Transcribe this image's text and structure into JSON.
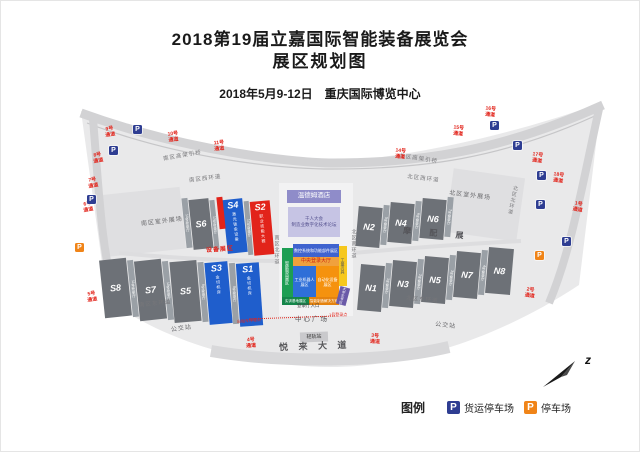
{
  "title": {
    "line1": "2018第19届立嘉国际智能装备展览会",
    "line2": "展区规划图",
    "subtitle": "2018年5月9-12日　重庆国际博览中心"
  },
  "legend": {
    "label": "图例",
    "items": [
      {
        "icon": "P",
        "color": "#2e3d92",
        "label": "货运停车场"
      },
      {
        "icon": "P",
        "color": "#f08418",
        "label": "停车场"
      }
    ]
  },
  "compass": {
    "letter": "z"
  },
  "map": {
    "halls": [
      {
        "id": "S6",
        "label": "S6",
        "type": "gray",
        "x": 190,
        "y": 198,
        "w": 20,
        "h": 50,
        "rot": -6,
        "sub": ""
      },
      {
        "id": "S4",
        "label": "S4",
        "type": "blue",
        "x": 224,
        "y": 198,
        "w": 20,
        "h": 54,
        "rot": -6,
        "sub": "激光钣金设备"
      },
      {
        "id": "S2",
        "label": "S2",
        "type": "red",
        "x": 251,
        "y": 200,
        "w": 20,
        "h": 54,
        "rot": -5,
        "sub": "职业技能大赛"
      },
      {
        "id": "S8",
        "label": "S8",
        "type": "gray",
        "x": 101,
        "y": 258,
        "w": 27,
        "h": 58,
        "rot": -6,
        "sub": ""
      },
      {
        "id": "S7",
        "label": "S7",
        "type": "gray",
        "x": 136,
        "y": 259,
        "w": 27,
        "h": 60,
        "rot": -6,
        "sub": ""
      },
      {
        "id": "S5",
        "label": "S5",
        "type": "gray",
        "x": 171,
        "y": 260,
        "w": 27,
        "h": 61,
        "rot": -5,
        "sub": ""
      },
      {
        "id": "S3",
        "label": "S3",
        "type": "blue",
        "x": 206,
        "y": 261,
        "w": 23,
        "h": 62,
        "rot": -5,
        "sub": "金切机床"
      },
      {
        "id": "S1",
        "label": "S1",
        "type": "blue",
        "x": 237,
        "y": 262,
        "w": 23,
        "h": 63,
        "rot": -4,
        "sub": "金切机床"
      },
      {
        "id": "N2",
        "label": "N2",
        "type": "gray",
        "x": 356,
        "y": 206,
        "w": 24,
        "h": 40,
        "rot": 5,
        "sub": ""
      },
      {
        "id": "N4",
        "label": "N4",
        "type": "gray",
        "x": 388,
        "y": 202,
        "w": 24,
        "h": 40,
        "rot": 5,
        "sub": ""
      },
      {
        "id": "N6",
        "label": "N6",
        "type": "gray",
        "x": 420,
        "y": 198,
        "w": 24,
        "h": 40,
        "rot": 5,
        "sub": ""
      },
      {
        "id": "N1",
        "label": "N1",
        "type": "gray",
        "x": 358,
        "y": 264,
        "w": 24,
        "h": 46,
        "rot": 5,
        "sub": ""
      },
      {
        "id": "N3",
        "label": "N3",
        "type": "gray",
        "x": 390,
        "y": 260,
        "w": 24,
        "h": 46,
        "rot": 5,
        "sub": ""
      },
      {
        "id": "N5",
        "label": "N5",
        "type": "gray",
        "x": 422,
        "y": 256,
        "w": 24,
        "h": 46,
        "rot": 5,
        "sub": ""
      },
      {
        "id": "N7",
        "label": "N7",
        "type": "gray",
        "x": 454,
        "y": 251,
        "w": 24,
        "h": 46,
        "rot": 5,
        "sub": ""
      },
      {
        "id": "N8",
        "label": "N8",
        "type": "gray",
        "x": 486,
        "y": 247,
        "w": 25,
        "h": 46,
        "rot": 5,
        "sub": ""
      }
    ],
    "strips": [
      {
        "label": "14号登录厅",
        "x": 183,
        "y": 197,
        "w": 6,
        "h": 50,
        "rot": -6
      },
      {
        "label": "13号登录厅",
        "x": 211,
        "y": 199,
        "w": 5,
        "h": 50,
        "rot": -6
      },
      {
        "label": "12号登录厅",
        "x": 245,
        "y": 200,
        "w": 5,
        "h": 54,
        "rot": -5
      },
      {
        "label": "11号登录厅",
        "x": 129,
        "y": 259,
        "w": 6,
        "h": 57,
        "rot": -6
      },
      {
        "label": "10号登录厅",
        "x": 164,
        "y": 260,
        "w": 6,
        "h": 59,
        "rot": -6
      },
      {
        "label": "9号登录厅",
        "x": 199,
        "y": 261,
        "w": 6,
        "h": 60,
        "rot": -5
      },
      {
        "label": "8号登录厅",
        "x": 230,
        "y": 262,
        "w": 6,
        "h": 61,
        "rot": -4
      },
      {
        "label": "5号登录厅",
        "x": 381,
        "y": 204,
        "w": 6,
        "h": 40,
        "rot": 5
      },
      {
        "label": "6号登录厅",
        "x": 413,
        "y": 200,
        "w": 6,
        "h": 40,
        "rot": 5
      },
      {
        "label": "7号登录厅",
        "x": 445,
        "y": 196,
        "w": 6,
        "h": 40,
        "rot": 5
      },
      {
        "label": "1号登录厅",
        "x": 383,
        "y": 262,
        "w": 6,
        "h": 45,
        "rot": 5
      },
      {
        "label": "2号登录厅",
        "x": 415,
        "y": 258,
        "w": 6,
        "h": 45,
        "rot": 5
      },
      {
        "label": "3号登录厅",
        "x": 447,
        "y": 254,
        "w": 6,
        "h": 45,
        "rot": 5
      },
      {
        "label": "4号登录厅",
        "x": 479,
        "y": 249,
        "w": 6,
        "h": 45,
        "rot": 5
      }
    ],
    "buildings": [
      {
        "name": "wyndham-hotel",
        "text": "温德姆酒店",
        "x": 286,
        "y": 189,
        "w": 54,
        "h": 13,
        "bg": "#8f8cc9",
        "fg": "#ffffff",
        "size": 6.5,
        "rot": 0,
        "vert": false
      },
      {
        "name": "forum-hall",
        "text": "千人大会\n制造业数字化技术论坛",
        "x": 287,
        "y": 206,
        "w": 52,
        "h": 30,
        "bg": "#c6c4e4",
        "fg": "#55518f",
        "size": 4.5,
        "rot": 0,
        "vert": false
      },
      {
        "name": "light-rail-station",
        "text": "轻轨站",
        "x": 299,
        "y": 331,
        "w": 28,
        "h": 10,
        "bg": "#c9c9cc",
        "fg": "#333333",
        "size": 5,
        "rot": -2,
        "vert": false
      }
    ],
    "zones": [
      {
        "name": "zone-cnc-systems",
        "text": "数控系统和功能部件展区",
        "x": 292,
        "y": 243,
        "w": 46,
        "h": 13,
        "bg": "#3f63cf",
        "fg": "#ffffff",
        "size": 4,
        "rot": 0,
        "vert": false
      },
      {
        "name": "zone-central-hall",
        "text": "中央登录大厅",
        "x": 292,
        "y": 256,
        "w": 46,
        "h": 9,
        "bg": "#f0a13d",
        "fg": "#cc2211",
        "size": 5,
        "rot": 0,
        "vert": false
      },
      {
        "name": "zone-smart-mfg",
        "text": "智能制造展区",
        "x": 281,
        "y": 247,
        "w": 11,
        "h": 49,
        "bg": "#1d9e53",
        "fg": "#ffffff",
        "size": 4,
        "rot": 0,
        "vert": true
      },
      {
        "name": "zone-robot",
        "text": "工业机器人展区",
        "x": 292,
        "y": 265,
        "w": 23,
        "h": 31,
        "bg": "#2f6fd8",
        "fg": "#ffffff",
        "size": 4,
        "rot": 0,
        "vert": false
      },
      {
        "name": "zone-automation",
        "text": "自动化设备展区",
        "x": 315,
        "y": 265,
        "w": 23,
        "h": 31,
        "bg": "#f5920e",
        "fg": "#ffffff",
        "size": 4,
        "rot": 0,
        "vert": false
      },
      {
        "name": "zone-tools",
        "text": "工量刃具",
        "x": 338,
        "y": 245,
        "w": 8,
        "h": 40,
        "bg": "#f6c81d",
        "fg": "#555555",
        "size": 4,
        "rot": 0,
        "vert": true
      },
      {
        "name": "zone-training-base",
        "text": "实训基地展区",
        "x": 281,
        "y": 296,
        "w": 27,
        "h": 8,
        "bg": "#15864a",
        "fg": "#ffffff",
        "size": 3.5,
        "rot": 0,
        "vert": false
      },
      {
        "name": "zone-solutions",
        "text": "智能制造解决方案",
        "x": 308,
        "y": 296,
        "w": 30,
        "h": 8,
        "bg": "#e5830f",
        "fg": "#ffffff",
        "size": 3.5,
        "rot": 0,
        "vert": false
      },
      {
        "name": "zone-students",
        "text": "大学生专区",
        "x": 337,
        "y": 286,
        "w": 10,
        "h": 18,
        "bg": "#6a5aa8",
        "fg": "#ffffff",
        "size": 3.5,
        "rot": 15,
        "vert": true
      },
      {
        "name": "zone-s4-red-strip",
        "text": "",
        "x": 217,
        "y": 196,
        "w": 6,
        "h": 32,
        "bg": "#e2231a",
        "fg": "#ffffff",
        "size": 3,
        "rot": -6,
        "vert": true
      }
    ],
    "labels": [
      {
        "text": "南区高架引桥",
        "x": 162,
        "y": 152,
        "size": 5.5,
        "rot": -10,
        "color": "#77777a",
        "sp": 1,
        "bold": false,
        "vert": false
      },
      {
        "text": "南区西环道",
        "x": 188,
        "y": 175,
        "size": 5.5,
        "rot": -7,
        "color": "#77777a",
        "sp": 1,
        "bold": false,
        "vert": false
      },
      {
        "text": "南区室外展场",
        "x": 140,
        "y": 218,
        "size": 6,
        "rot": -7,
        "color": "#6a6a6d",
        "sp": 1,
        "bold": false,
        "vert": false
      },
      {
        "text": "南区东环道",
        "x": 138,
        "y": 300,
        "size": 5.5,
        "rot": -6,
        "color": "#77777a",
        "sp": 1,
        "bold": false,
        "vert": false
      },
      {
        "text": "公交站",
        "x": 170,
        "y": 325,
        "size": 6,
        "rot": -8,
        "color": "#6a6a6d",
        "sp": 1,
        "bold": false,
        "vert": false
      },
      {
        "text": "悦 来 大 道",
        "x": 278,
        "y": 341,
        "size": 9,
        "rot": -2,
        "color": "#555558",
        "sp": 4,
        "bold": true,
        "vert": false
      },
      {
        "text": "中心广场",
        "x": 294,
        "y": 315,
        "size": 6.5,
        "rot": 0,
        "color": "#555558",
        "sp": 2,
        "bold": false,
        "vert": false
      },
      {
        "text": "登录厅入口",
        "x": 296,
        "y": 303,
        "size": 4.5,
        "rot": 0,
        "color": "#444446",
        "sp": 0,
        "bold": false,
        "vert": false
      },
      {
        "text": "北区高架引桥",
        "x": 398,
        "y": 155,
        "size": 5.5,
        "rot": 9,
        "color": "#77777a",
        "sp": 1,
        "bold": false,
        "vert": false
      },
      {
        "text": "北区西环道",
        "x": 406,
        "y": 175,
        "size": 5.5,
        "rot": 7,
        "color": "#77777a",
        "sp": 1,
        "bold": false,
        "vert": false
      },
      {
        "text": "北区室外展场",
        "x": 448,
        "y": 192,
        "size": 6,
        "rot": 7,
        "color": "#6a6a6d",
        "sp": 1,
        "bold": false,
        "vert": false
      },
      {
        "text": "摩 配 展",
        "x": 402,
        "y": 229,
        "size": 8,
        "rot": 5,
        "color": "#55555a",
        "sp": 8,
        "bold": true,
        "vert": false
      },
      {
        "text": "北区东环道",
        "x": 405,
        "y": 296,
        "size": 5.5,
        "rot": 5,
        "color": "#77777a",
        "sp": 1,
        "bold": false,
        "vert": false
      },
      {
        "text": "公交站",
        "x": 434,
        "y": 322,
        "size": 6,
        "rot": 6,
        "color": "#6a6a6d",
        "sp": 1,
        "bold": false,
        "vert": false
      },
      {
        "text": "设备展区",
        "x": 205,
        "y": 246,
        "size": 6,
        "rot": -4,
        "color": "#e2231a",
        "sp": 1,
        "bold": true,
        "vert": false
      },
      {
        "text": "出租车停靠点",
        "x": 236,
        "y": 318,
        "size": 4,
        "rot": -5,
        "color": "#e2231a",
        "sp": 0,
        "bold": false,
        "vert": false
      },
      {
        "text": "1号登录点",
        "x": 328,
        "y": 312,
        "size": 4,
        "rot": 0,
        "color": "#e2231a",
        "sp": 0,
        "bold": false,
        "vert": false
      },
      {
        "text": "南区北环道",
        "x": 272,
        "y": 234,
        "size": 5,
        "rot": 0,
        "color": "#77777a",
        "sp": 1,
        "bold": false,
        "vert": true
      },
      {
        "text": "北区南环道",
        "x": 349,
        "y": 228,
        "size": 5,
        "rot": 0,
        "color": "#77777a",
        "sp": 1,
        "bold": false,
        "vert": true
      },
      {
        "text": "北区北环道",
        "x": 508,
        "y": 184,
        "size": 5,
        "rot": 12,
        "color": "#77777a",
        "sp": 1,
        "bold": false,
        "vert": true
      }
    ],
    "passages": [
      {
        "text": "9号通道",
        "x": 104,
        "y": 126,
        "rot": -8
      },
      {
        "text": "10号通道",
        "x": 167,
        "y": 131,
        "rot": -6
      },
      {
        "text": "11号通道",
        "x": 213,
        "y": 140,
        "rot": -4
      },
      {
        "text": "8号通道",
        "x": 92,
        "y": 152,
        "rot": -10
      },
      {
        "text": "7号通道",
        "x": 87,
        "y": 177,
        "rot": -10
      },
      {
        "text": "6号通道",
        "x": 82,
        "y": 201,
        "rot": -10
      },
      {
        "text": "5号通道",
        "x": 86,
        "y": 291,
        "rot": -8
      },
      {
        "text": "4号通道",
        "x": 245,
        "y": 337,
        "rot": -3
      },
      {
        "text": "3号通道",
        "x": 369,
        "y": 333,
        "rot": 3
      },
      {
        "text": "2号通道",
        "x": 524,
        "y": 287,
        "rot": 8
      },
      {
        "text": "1号通道",
        "x": 572,
        "y": 201,
        "rot": 10
      },
      {
        "text": "14号通道",
        "x": 394,
        "y": 148,
        "rot": 6
      },
      {
        "text": "15号通道",
        "x": 452,
        "y": 125,
        "rot": 6
      },
      {
        "text": "16号通道",
        "x": 484,
        "y": 106,
        "rot": 6
      },
      {
        "text": "17号通道",
        "x": 531,
        "y": 152,
        "rot": 8
      },
      {
        "text": "18号通道",
        "x": 552,
        "y": 172,
        "rot": 8
      }
    ],
    "parking": [
      {
        "x": 132,
        "y": 124,
        "kind": "blue"
      },
      {
        "x": 108,
        "y": 145,
        "kind": "blue"
      },
      {
        "x": 86,
        "y": 194,
        "kind": "blue"
      },
      {
        "x": 74,
        "y": 242,
        "kind": "orange"
      },
      {
        "x": 489,
        "y": 120,
        "kind": "blue"
      },
      {
        "x": 512,
        "y": 140,
        "kind": "blue"
      },
      {
        "x": 536,
        "y": 170,
        "kind": "blue"
      },
      {
        "x": 535,
        "y": 199,
        "kind": "blue"
      },
      {
        "x": 561,
        "y": 236,
        "kind": "blue"
      },
      {
        "x": 534,
        "y": 250,
        "kind": "orange"
      }
    ],
    "route": {
      "x": 248,
      "y": 316,
      "w": 86,
      "rot": -2
    }
  }
}
